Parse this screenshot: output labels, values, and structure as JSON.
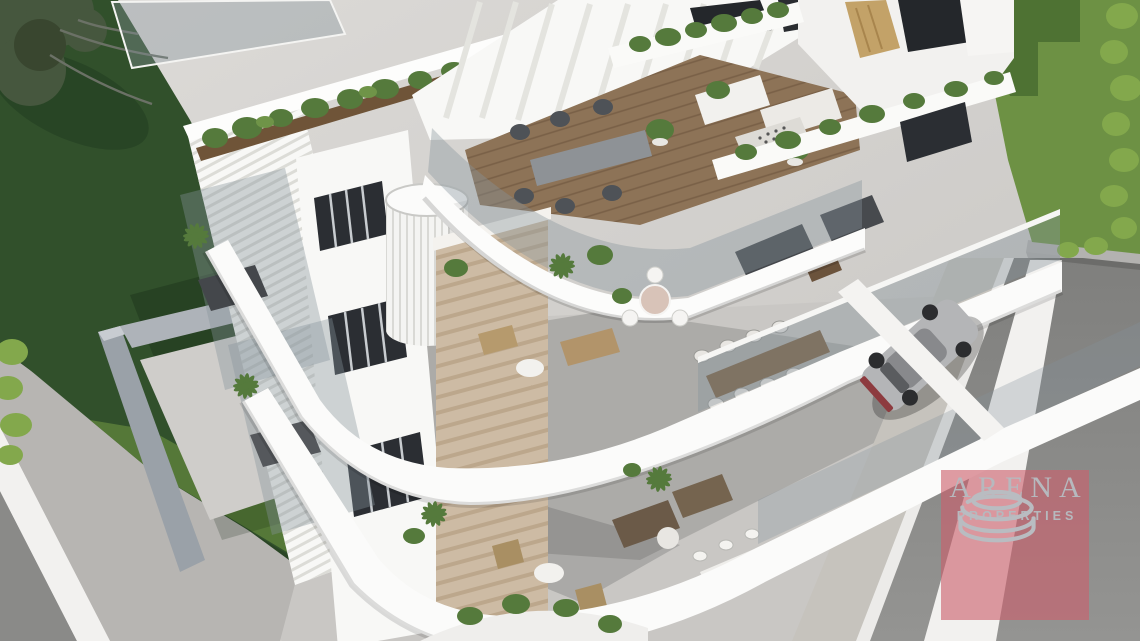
{
  "scene": {
    "kind": "architectural-3d-render",
    "description": "Aerial corner view of a modern white multi-storey apartment building with curved wrap-around balconies, rooftop pergola terrace, travertine stone columns, landscaped lawns, hedges, corner streets with white road markings, and a silver car parked in the covered driveway"
  },
  "watermark": {
    "brand": "ARENA",
    "tagline": "PROPERTIES",
    "logo": "stacked-ellipse-arena-rings",
    "panel_rgba": "rgba(203,96,108,0.62)",
    "text_color": "#b6b9be",
    "logo_color": "#b9bcc1"
  },
  "colors": {
    "ground": "#d6d4d1",
    "pavement": "#c9c7c4",
    "sidewalk_left": "#b7b5b2",
    "sidewalk_right": "#c6c3bd",
    "road": "#8a8a88",
    "curb": "#f2f1ef",
    "wall_concrete": "#b3b2b0",
    "lawn_left": "#31502b",
    "lawn_left_light": "#5a7c3a",
    "lawn_right": "#6d9144",
    "lawn_right_shadow": "#4e7233",
    "hedge": "#83a84c",
    "tree_foliage": "#46573e",
    "building_white": "#f8f8f6",
    "glass": "rgba(134,147,155,0.38)",
    "travertine": "#cdbba4",
    "wood_planter": "#6f5438",
    "wood_deck": "#8d7357",
    "table_wood": "#7b5f42",
    "dark_panel": "#24272b",
    "gold_louver": "#c3a268",
    "foliage": "#557a3c",
    "furniture_gray": "#44474b",
    "furniture_tan": "#b2946a",
    "car_body": "#b4b5b7",
    "car_tail": "#8d3b3f"
  }
}
